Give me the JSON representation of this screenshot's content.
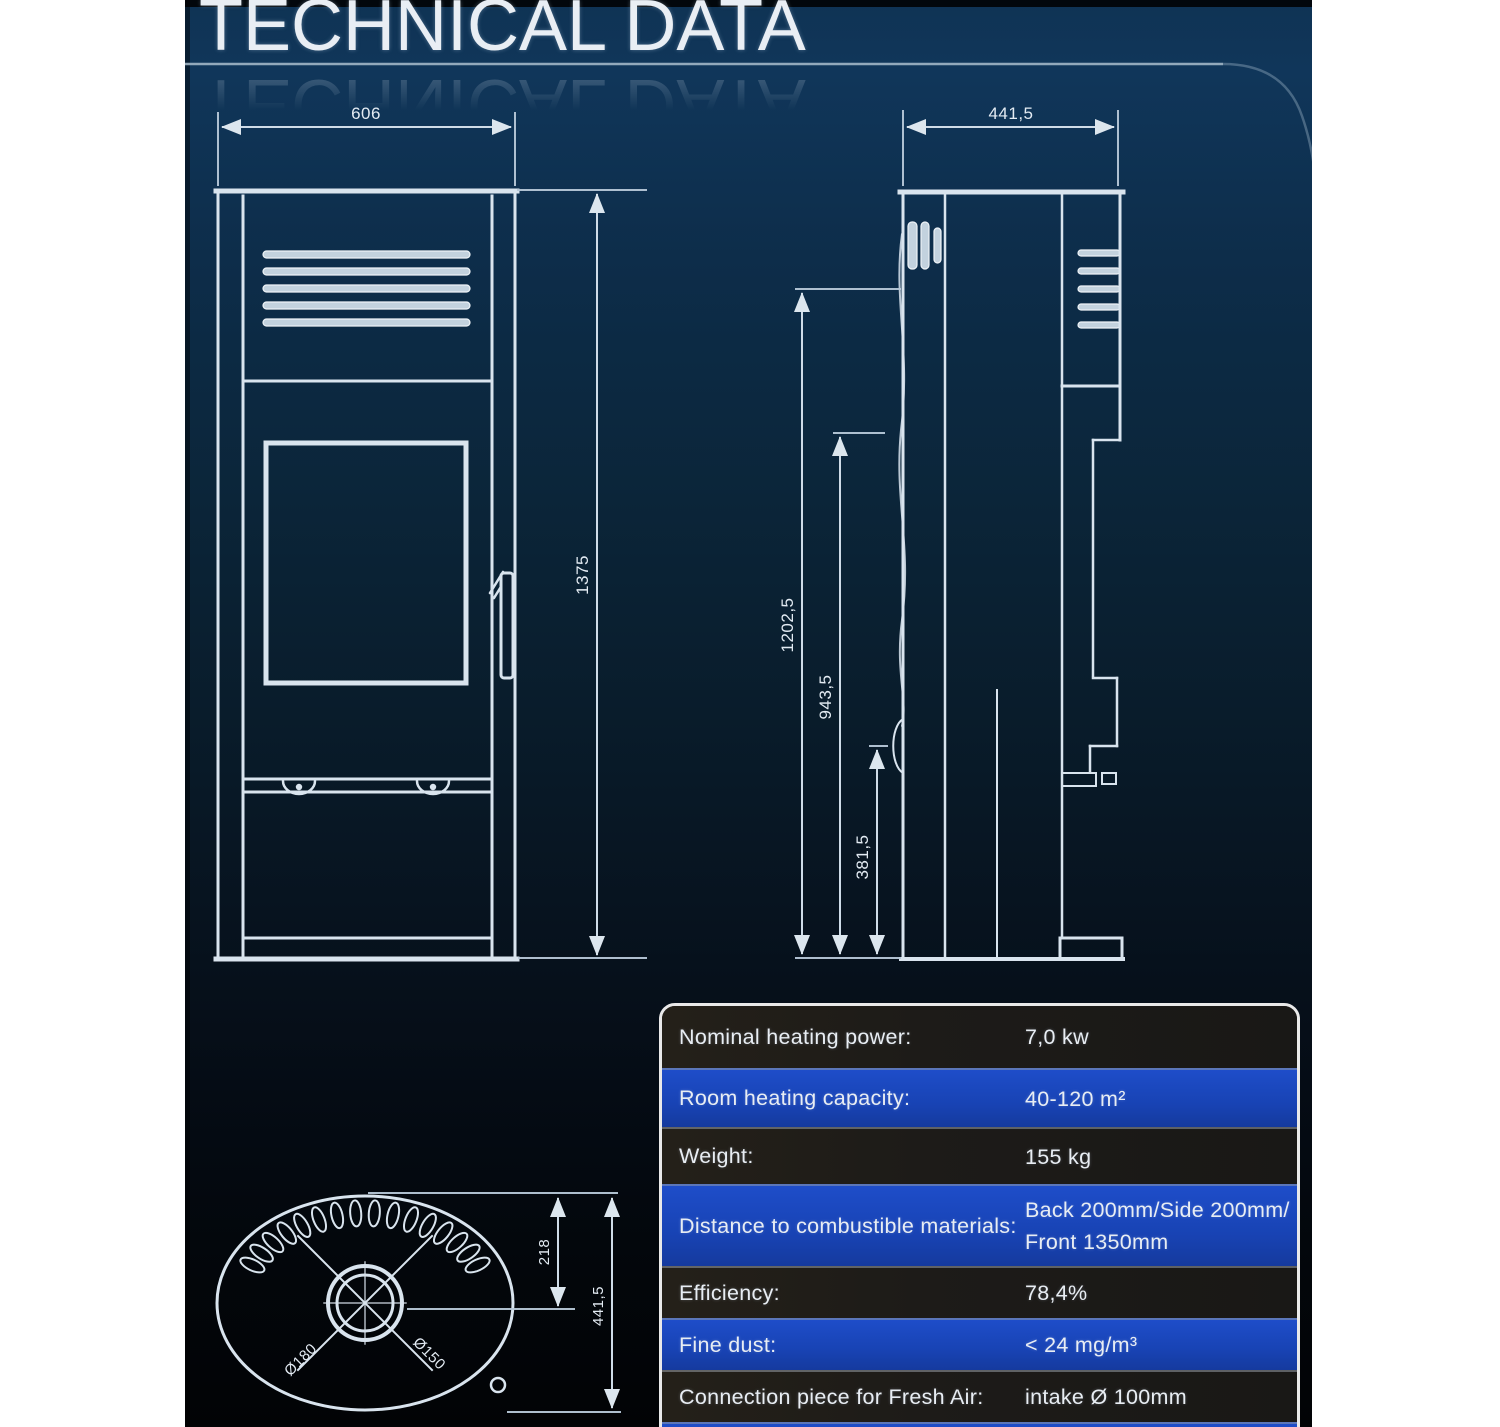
{
  "title": "TECHNICAL DATA",
  "drawings": {
    "front": {
      "width": "606",
      "height": "1375"
    },
    "side": {
      "depth": "441,5",
      "height_total": "1202,5",
      "height_mid": "943,5",
      "height_low": "381,5"
    },
    "bottom": {
      "top_to_center": "218",
      "depth": "441,5",
      "flue_diameter": "Ø180",
      "flue_inner_diameter": "Ø150"
    }
  },
  "table": {
    "rows": [
      {
        "label": "Nominal heating power:",
        "value": "7,0 kw"
      },
      {
        "label": "Room heating capacity:",
        "value": "40-120 m²"
      },
      {
        "label": "Weight:",
        "value": "155 kg"
      },
      {
        "label": "Distance to combustible materials:",
        "value": "Back 200mm/Side 200mm/",
        "value2": "Front 1350mm"
      },
      {
        "label": "Efficiency:",
        "value": "78,4%"
      },
      {
        "label": "Fine dust:",
        "value": "< 24 mg/m³"
      },
      {
        "label": "Connection piece for Fresh Air:",
        "value": "intake Ø 100mm"
      }
    ]
  },
  "colors": {
    "accent_blue": "#1a46bd",
    "row_dark": "#1d1b19",
    "line": "#d9e4ee",
    "background_top": "#0f3354"
  }
}
